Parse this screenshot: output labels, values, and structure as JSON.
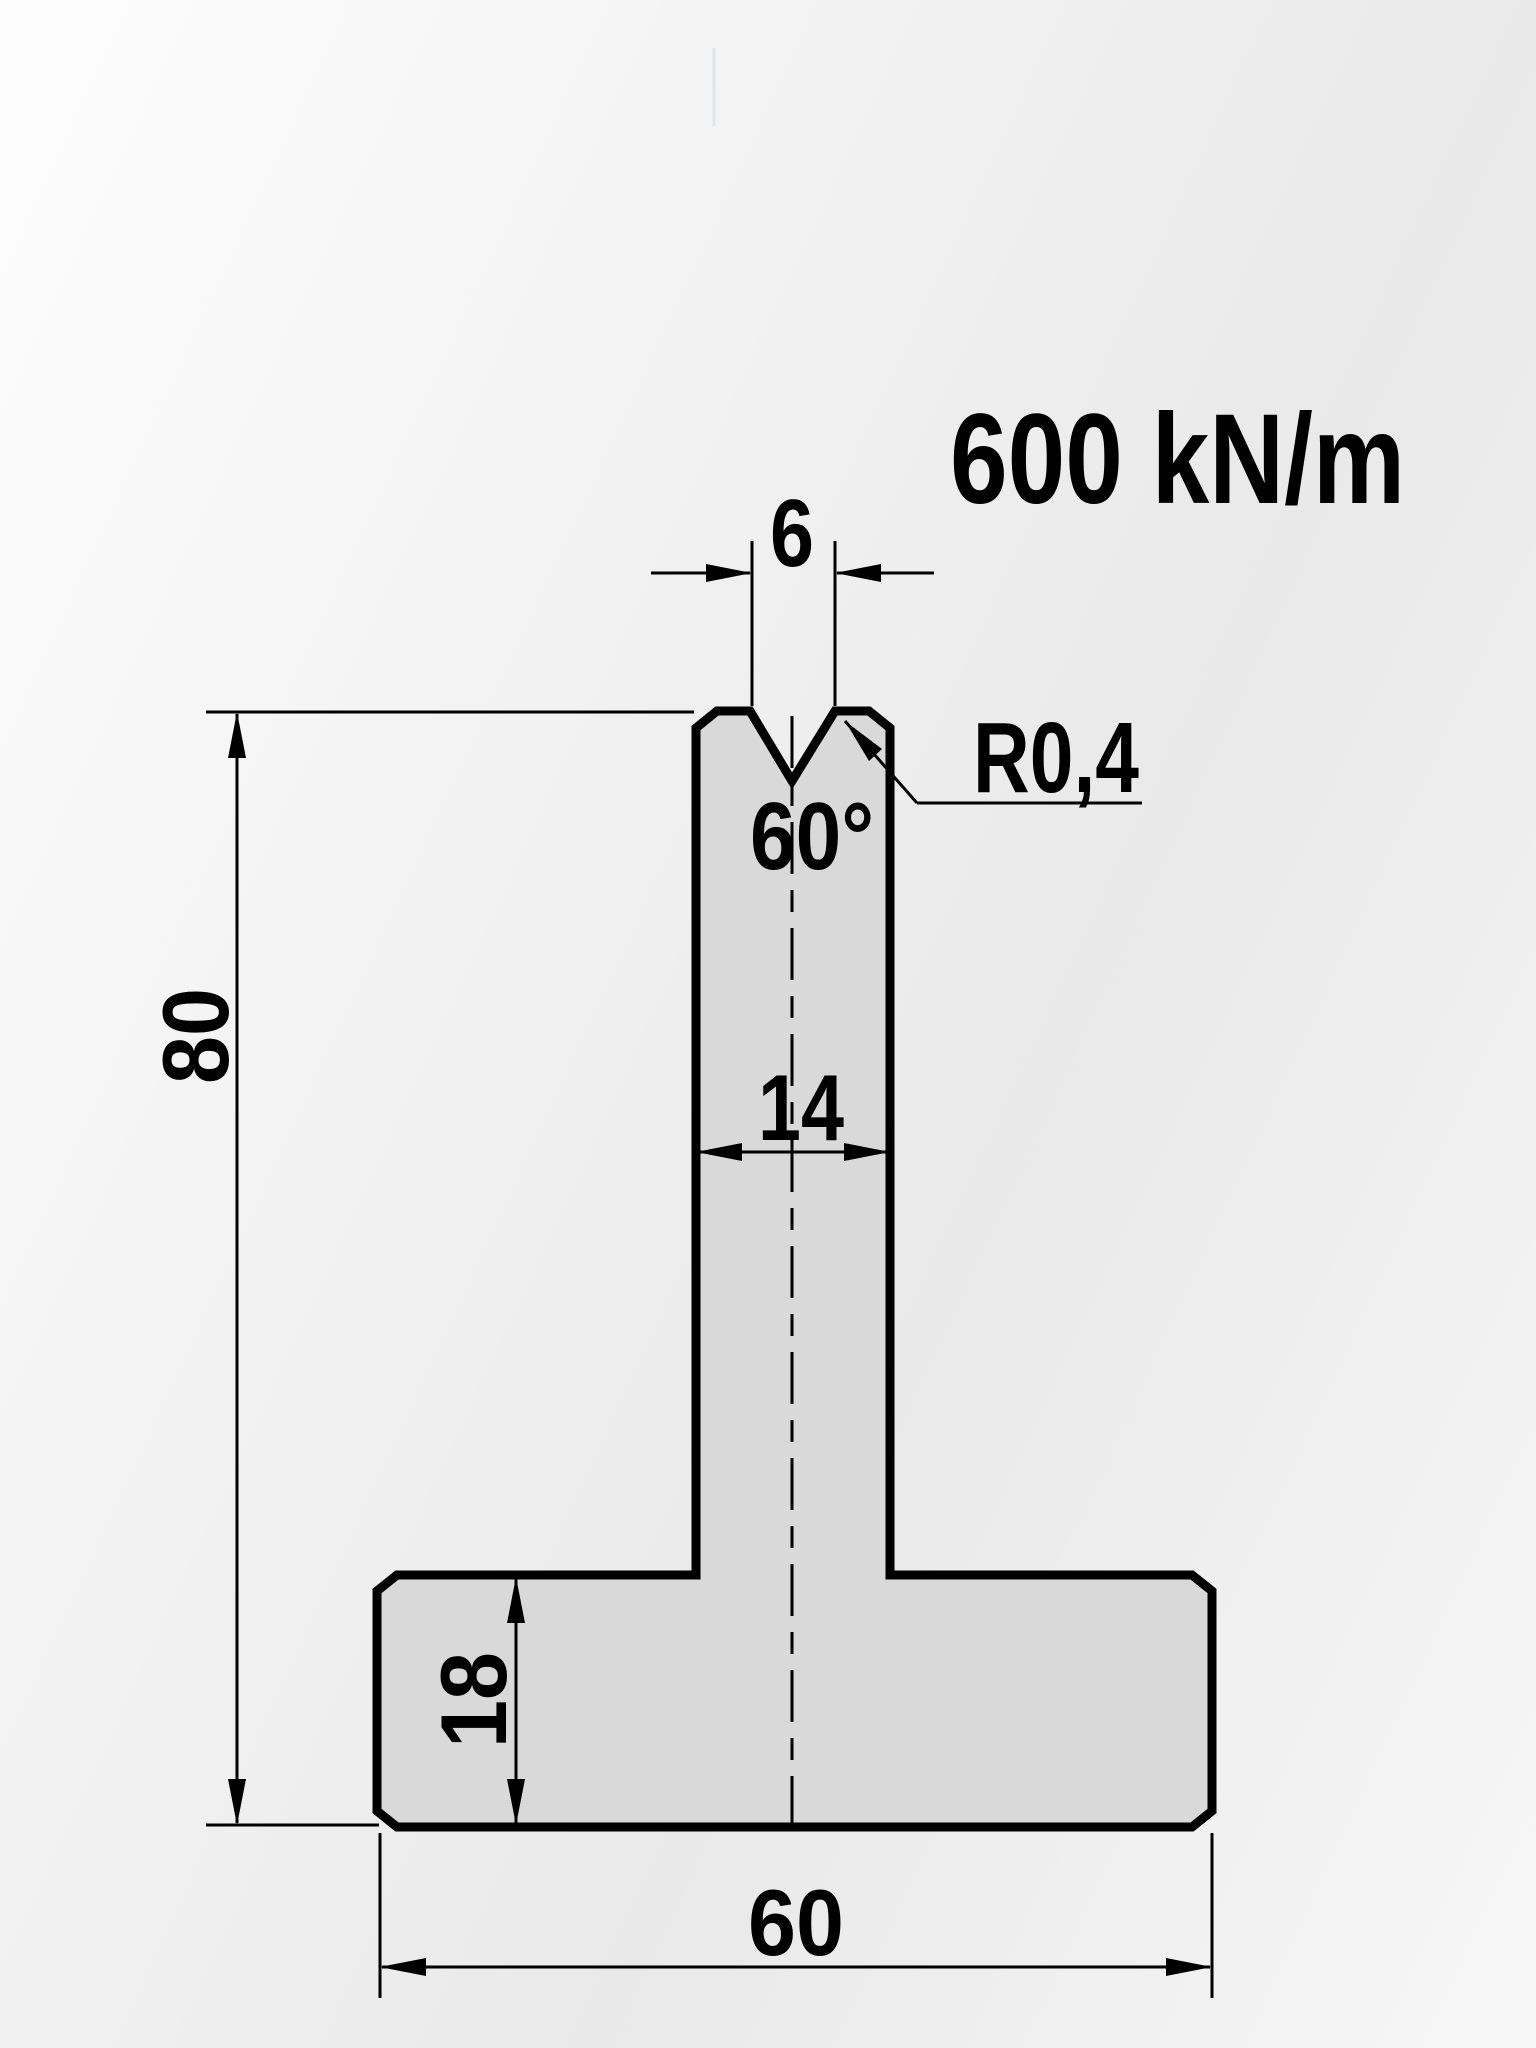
{
  "drawing": {
    "load_rating": "600 kN/m",
    "dimensions": {
      "vee_opening": "6",
      "vee_angle": "60°",
      "vee_radius": "R0,4",
      "stem_width": "14",
      "total_height": "80",
      "base_height": "18",
      "base_width": "60"
    },
    "colors": {
      "line": "#000000",
      "shape_fill": "#d9d9d9",
      "background_light": "#fdfdfd",
      "background_shade": "#e9e9e9"
    }
  }
}
